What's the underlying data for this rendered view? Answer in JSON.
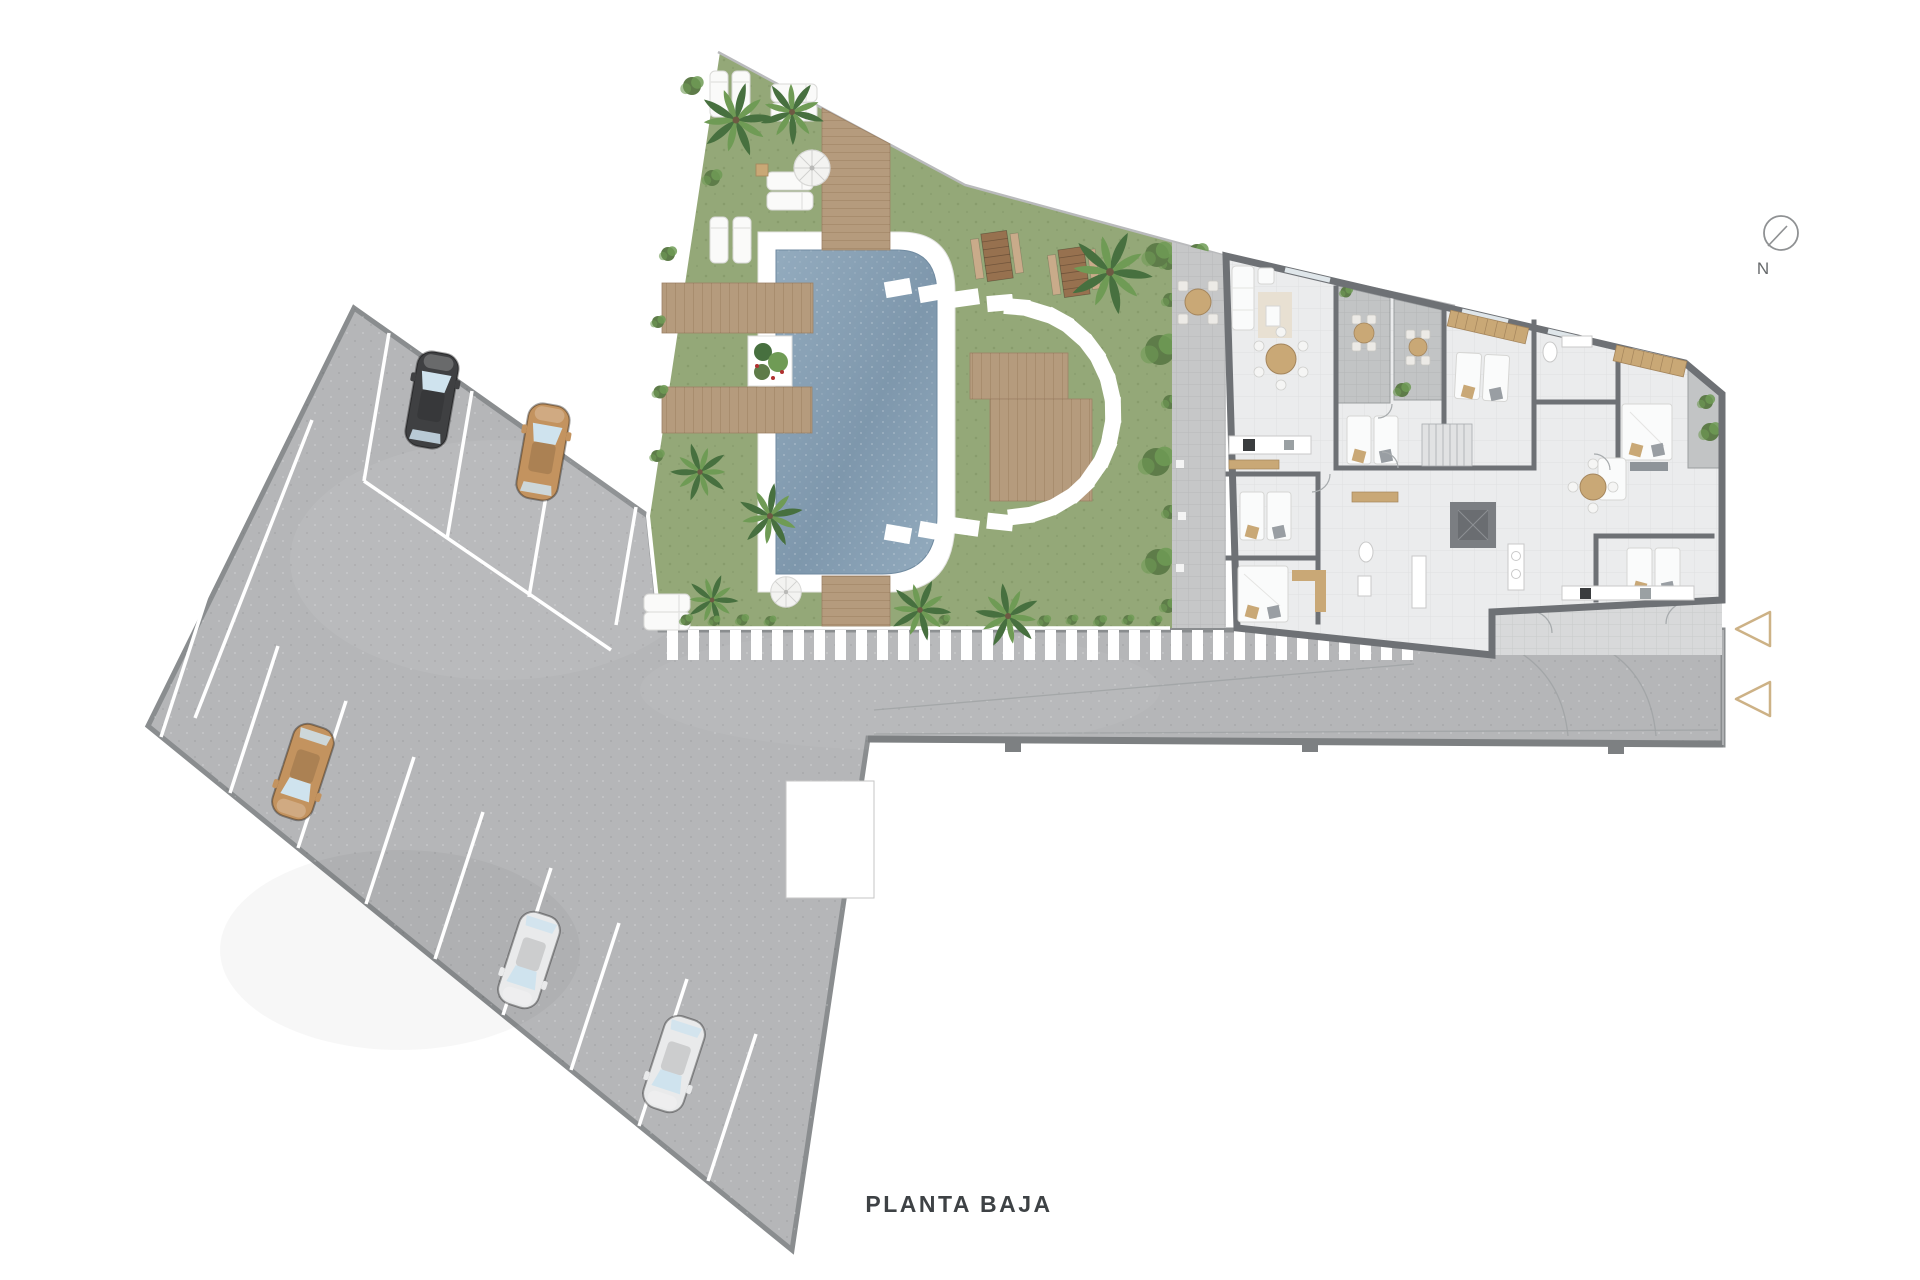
{
  "plan": {
    "title": "PLANTA BAJA"
  },
  "compass": {
    "label": "N"
  },
  "palette": {
    "background": "#ffffff",
    "pavement": "#b5b6b8",
    "pavement_border": "#8a8d8f",
    "wall_dark": "#7d8082",
    "marking": "#ffffff",
    "guide_line": "#9fa2a4",
    "grass": "#94a878",
    "grass_dark": "#7d9263",
    "hedge": "#5e7c49",
    "palm_dark": "#47703f",
    "palm_light": "#6f9b55",
    "wood": "#b59b7d",
    "wood_edge": "#9d8266",
    "picnic_wood": "#97714f",
    "pool_water_a": "#93abbe",
    "pool_water_b": "#7e97ac",
    "pool_coping": "#ffffff",
    "gravel_path": "#c6c7c8",
    "building_floor": "#ebeced",
    "building_wall": "#6e7175",
    "terrace_tile": "#c2c4c5",
    "furniture_white": "#fafbfb",
    "furniture_tan": "#c9a876",
    "car_black": "#3f4042",
    "car_tan": "#c3935f",
    "car_white": "#e9eaeb",
    "glass": "#cfe3ee",
    "arrow": "#cdb286",
    "boundary": "#b9babc",
    "text": "#3e4245"
  }
}
